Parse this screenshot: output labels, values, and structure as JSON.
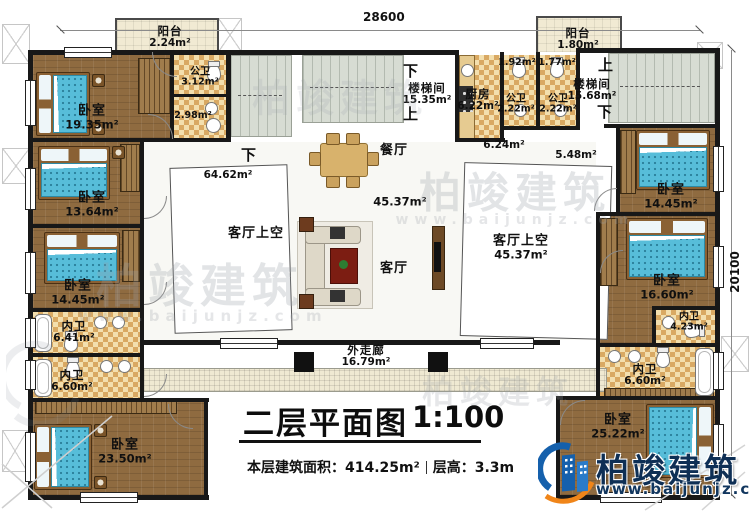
{
  "dimensions": {
    "top": "28600",
    "right": "20100"
  },
  "title": {
    "main": "二层平面图",
    "scale": "1:100",
    "area_label": "本层建筑面积：",
    "area_value": "414.25m²",
    "floor_height_label": "层高：",
    "floor_height_value": "3.3m"
  },
  "brand": {
    "name": "柏竣建筑",
    "website": "www.baijunjz.com"
  },
  "colors": {
    "wall": "#181818",
    "wood_floor": "#8f6b40",
    "bath_tile": "#f3dfae",
    "balcony": "#f1ead3",
    "stair": "#d7dcd3",
    "bed": "#57bdd9",
    "logo_blue": "#1560ac",
    "logo_orange": "#f08519",
    "logo_text": "#0e2f55"
  },
  "labels": [
    {
      "id": "balcony-tl",
      "t": "阳台",
      "a": "2.24m²",
      "x": 170,
      "y": 37,
      "s": "sm"
    },
    {
      "id": "bedroom-1935",
      "t": "卧室",
      "a": "19.35m²",
      "x": 92,
      "y": 118,
      "s": "md"
    },
    {
      "id": "bath-gw-312",
      "t": "公卫",
      "a": "3.12m²",
      "x": 200,
      "y": 77,
      "s": "xs"
    },
    {
      "id": "bath-298",
      "a": "2.98m²",
      "x": 193,
      "y": 116,
      "s": "xs"
    },
    {
      "id": "bedroom-1364",
      "t": "卧室",
      "a": "13.64m²",
      "x": 92,
      "y": 205,
      "s": "md"
    },
    {
      "id": "bedroom-1445-left",
      "t": "卧室",
      "a": "14.45m²",
      "x": 78,
      "y": 293,
      "s": "md"
    },
    {
      "id": "bath-nw-641",
      "t": "内卫",
      "a": "6.41m²",
      "x": 74,
      "y": 332,
      "s": "sm"
    },
    {
      "id": "bath-nw-660-left",
      "t": "内卫",
      "a": "6.60m²",
      "x": 72,
      "y": 381,
      "s": "sm"
    },
    {
      "id": "bedroom-2350",
      "t": "卧室",
      "a": "23.50m²",
      "x": 125,
      "y": 452,
      "s": "md"
    },
    {
      "id": "stair-down-left",
      "t": "下",
      "x": 249,
      "y": 155,
      "s": "dir"
    },
    {
      "id": "hall-6462",
      "a": "64.62m²",
      "x": 228,
      "y": 176,
      "s": "sm"
    },
    {
      "id": "stair-down-center",
      "t": "下",
      "x": 411,
      "y": 71,
      "s": "dir"
    },
    {
      "id": "stairwell-center",
      "t": "楼梯间",
      "a": "15.35m²",
      "x": 427,
      "y": 94,
      "s": "sm"
    },
    {
      "id": "stair-up-center",
      "t": "上",
      "x": 411,
      "y": 114,
      "s": "dir"
    },
    {
      "id": "dining-room",
      "t": "餐厅",
      "x": 394,
      "y": 151,
      "s": "md"
    },
    {
      "id": "hall-4537",
      "a": "45.37m²",
      "x": 400,
      "y": 202,
      "s": "md"
    },
    {
      "id": "living-room",
      "t": "客厅",
      "x": 394,
      "y": 269,
      "s": "md"
    },
    {
      "id": "void-left",
      "t": "客厅上空",
      "x": 256,
      "y": 234,
      "s": "md"
    },
    {
      "id": "void-right",
      "t": "客厅上空",
      "a": "45.37m²",
      "x": 521,
      "y": 248,
      "s": "md"
    },
    {
      "id": "kitchen",
      "t": "厨房",
      "a": "6.22m²",
      "x": 478,
      "y": 100,
      "s": "sm"
    },
    {
      "id": "gw-192",
      "a": "1.92m²",
      "x": 517,
      "y": 63,
      "s": "xs"
    },
    {
      "id": "gw-177",
      "a": "1.77m²",
      "x": 557,
      "y": 63,
      "s": "xs"
    },
    {
      "id": "bath-gw-222-a",
      "t": "公卫",
      "a": "2.22m²",
      "x": 516,
      "y": 104,
      "s": "xs"
    },
    {
      "id": "bath-gw-222-b",
      "t": "公卫",
      "a": "2.22m²",
      "x": 558,
      "y": 104,
      "s": "xs"
    },
    {
      "id": "balcony-tr",
      "t": "阳台",
      "a": "1.80m²",
      "x": 578,
      "y": 39,
      "s": "sm"
    },
    {
      "id": "stair-up-right",
      "t": "上",
      "x": 606,
      "y": 65,
      "s": "dir"
    },
    {
      "id": "stairwell-right",
      "t": "楼梯间",
      "a": "15.68m²",
      "x": 592,
      "y": 90,
      "s": "sm"
    },
    {
      "id": "stair-down-right",
      "t": "下",
      "x": 605,
      "y": 112,
      "s": "dir"
    },
    {
      "id": "hall-624",
      "a": "6.24m²",
      "x": 504,
      "y": 146,
      "s": "sm"
    },
    {
      "id": "hall-548",
      "a": "5.48m²",
      "x": 576,
      "y": 156,
      "s": "sm"
    },
    {
      "id": "bedroom-1445-right",
      "t": "卧室",
      "a": "14.45m²",
      "x": 671,
      "y": 197,
      "s": "md"
    },
    {
      "id": "bedroom-1660",
      "t": "卧室",
      "a": "16.60m²",
      "x": 667,
      "y": 288,
      "s": "md"
    },
    {
      "id": "bath-nw-423",
      "t": "内卫",
      "a": "4.23m²",
      "x": 689,
      "y": 322,
      "s": "xs"
    },
    {
      "id": "bath-nw-660-right",
      "t": "内卫",
      "a": "6.60m²",
      "x": 645,
      "y": 375,
      "s": "sm"
    },
    {
      "id": "bedroom-2522",
      "t": "卧室",
      "a": "25.22m²",
      "x": 618,
      "y": 427,
      "s": "md"
    },
    {
      "id": "outer-corridor",
      "t": "外走廊",
      "a": "16.79m²",
      "x": 366,
      "y": 356,
      "s": "sm"
    }
  ],
  "watermarks": [
    {
      "text": "柏竣建筑",
      "x": 200,
      "y": 283,
      "size": 46,
      "op": 0.28
    },
    {
      "text": "www.baijunjz.com",
      "x": 203,
      "y": 316,
      "size": 15,
      "op": 0.25
    },
    {
      "text": "柏竣建筑",
      "x": 515,
      "y": 190,
      "size": 42,
      "op": 0.28
    },
    {
      "text": "www.baijunjz.com",
      "x": 515,
      "y": 220,
      "size": 14,
      "op": 0.25
    },
    {
      "text": "柏竣建筑",
      "x": 340,
      "y": 95,
      "size": 38,
      "op": 0.18
    },
    {
      "text": "柏竣建筑",
      "x": 498,
      "y": 390,
      "size": 32,
      "op": 0.24
    }
  ]
}
